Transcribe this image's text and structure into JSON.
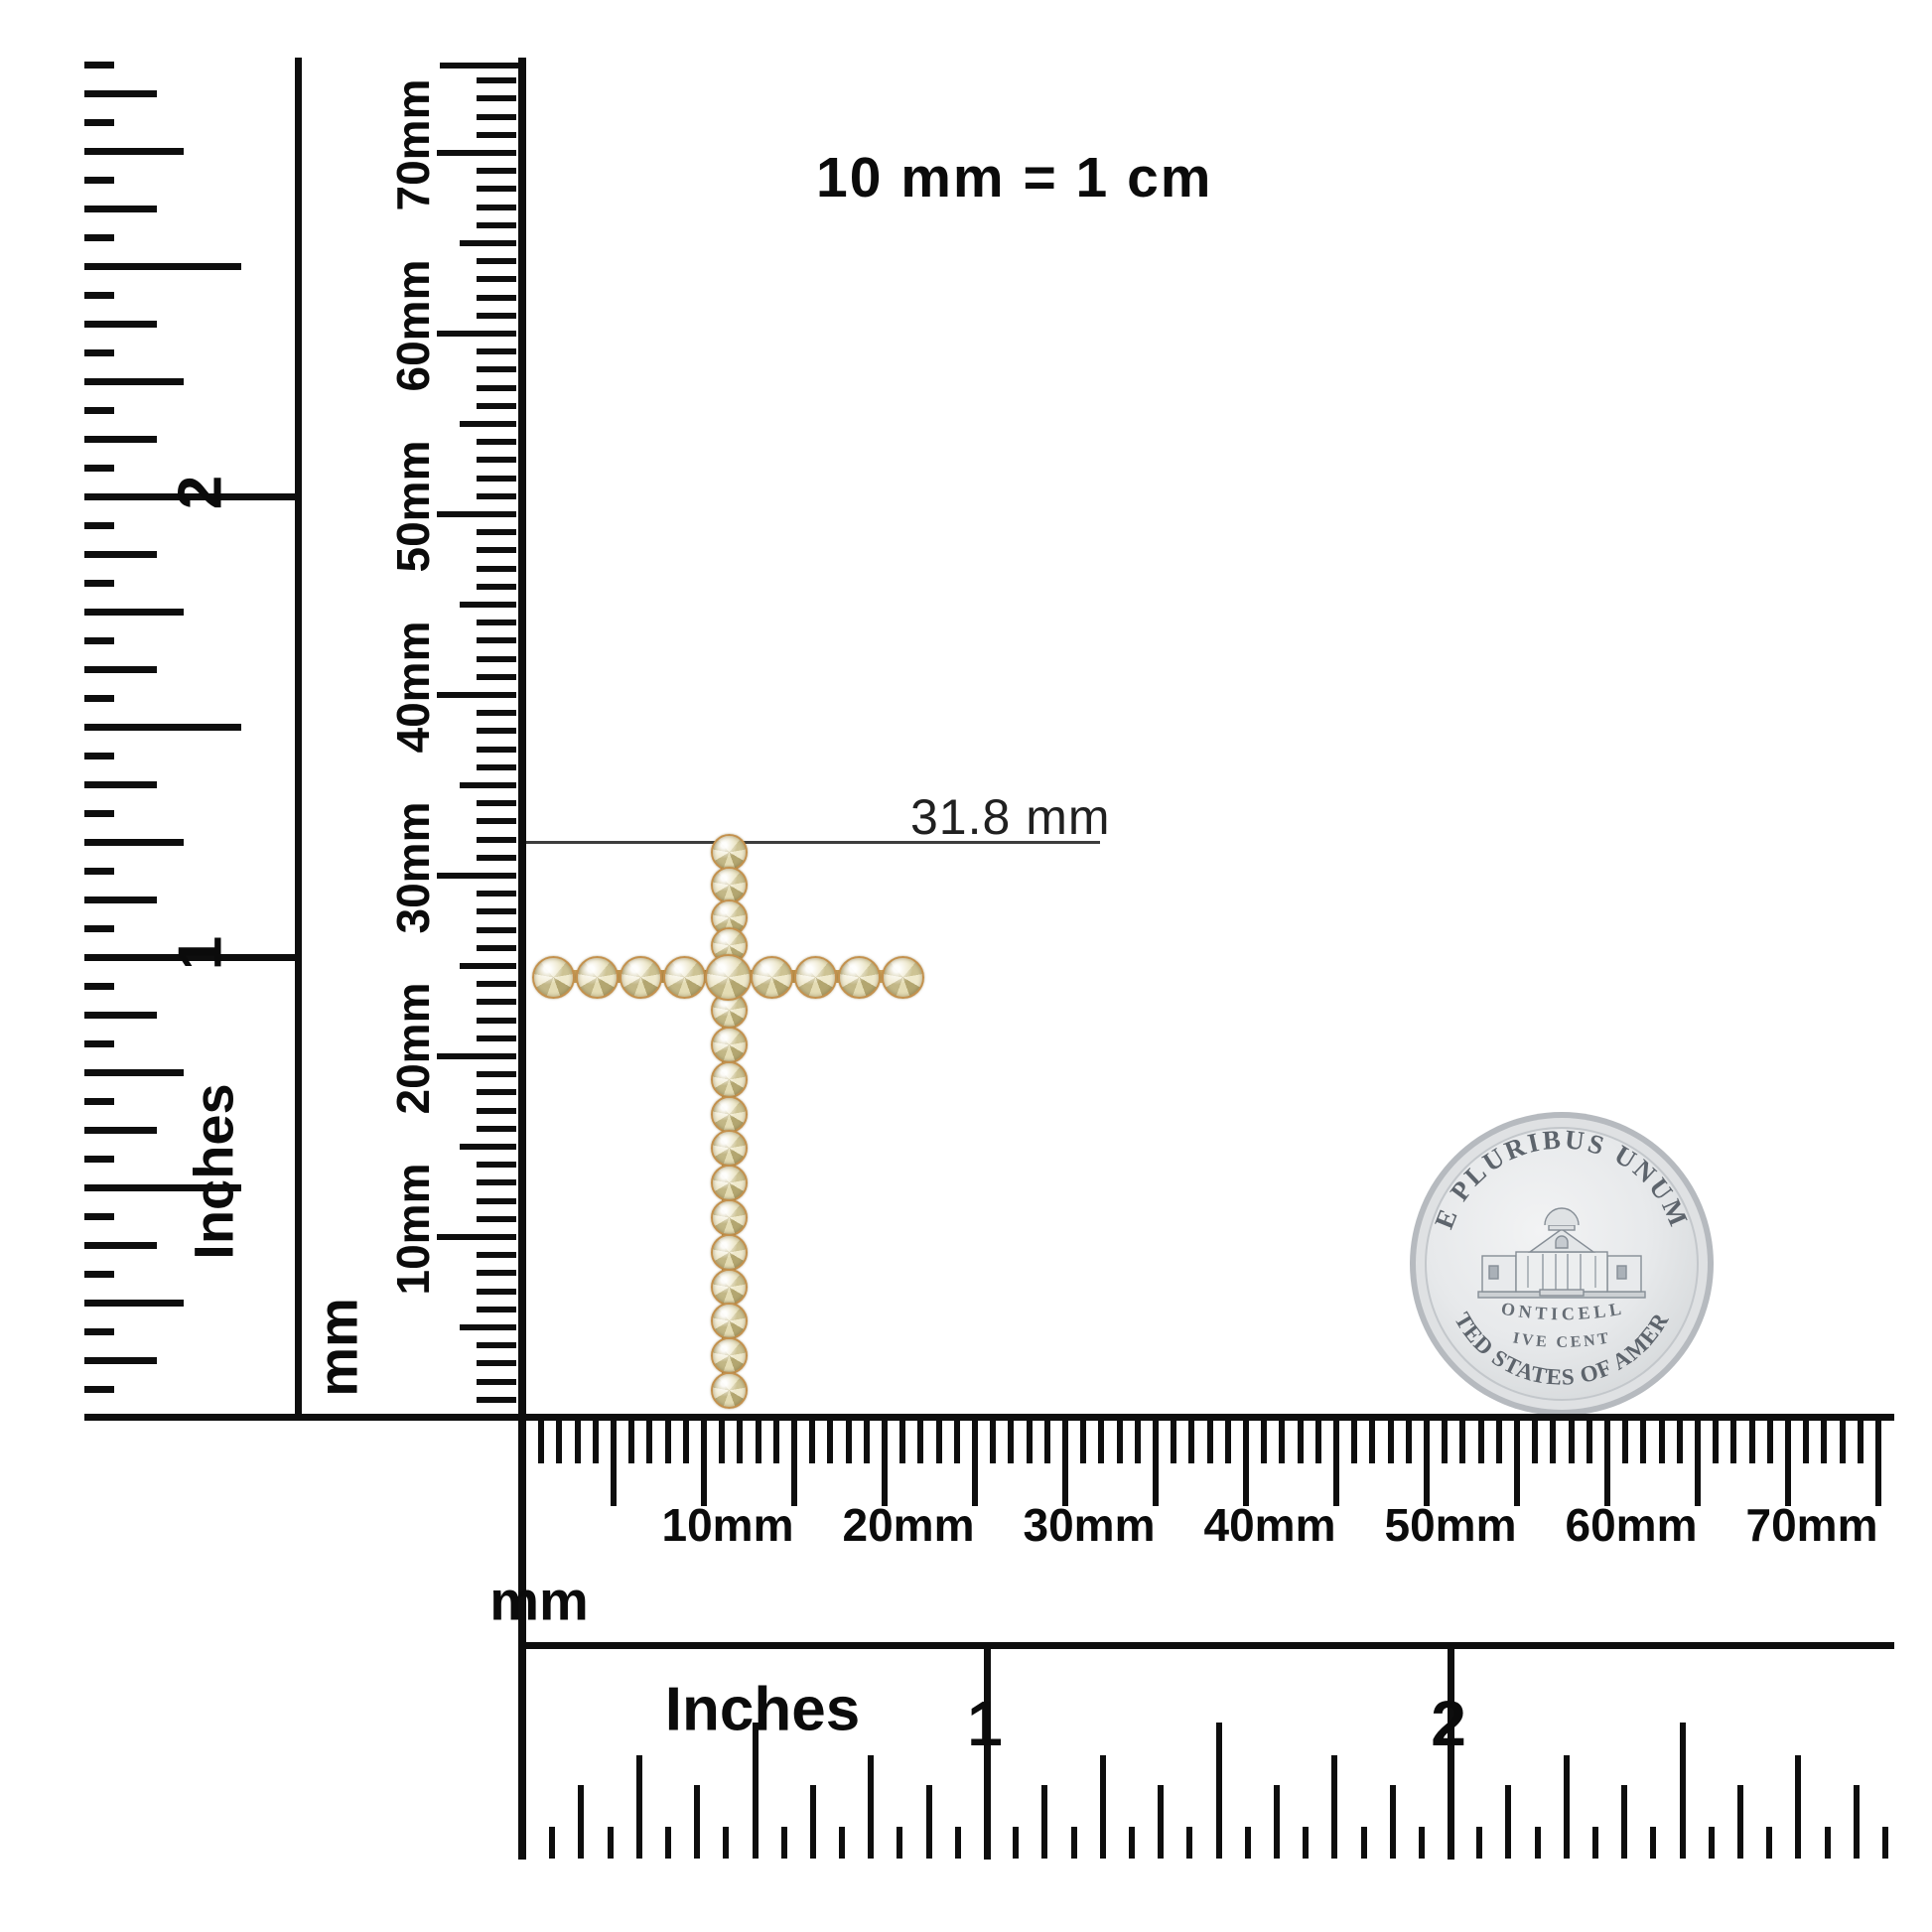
{
  "title_note": "10 mm = 1 cm",
  "annotation": {
    "label": "31.8 mm"
  },
  "rulers": {
    "left_inches": {
      "unit": "Inches",
      "labels": [
        "2",
        "1"
      ]
    },
    "left_mm": {
      "unit": "mm",
      "labels": [
        "10mm",
        "20mm",
        "30mm",
        "40mm",
        "50mm",
        "60mm",
        "70mm"
      ]
    },
    "bottom_mm": {
      "unit": "mm",
      "labels": [
        "10mm",
        "20mm",
        "30mm",
        "40mm",
        "50mm",
        "60mm",
        "70mm"
      ]
    },
    "bottom_inches": {
      "unit": "Inches",
      "labels": [
        "1",
        "2"
      ]
    }
  },
  "coin": {
    "legend_top": "E PLURIBUS UNUM",
    "building": "MONTICELLO",
    "denomination": "FIVE CENTS",
    "legend_bottom": "UNITED STATES OF AMERICA"
  },
  "pendant": {
    "type": "diamond cross pendant",
    "vertical_stones": 17,
    "horizontal_stones": 9,
    "stone_color": "#d8cfa0",
    "metal_color": "#c89a55"
  },
  "colors": {
    "ink": "#0e0e0e",
    "measure_line": "#3d3d3d",
    "coin_silver": "#e7e9eb"
  }
}
